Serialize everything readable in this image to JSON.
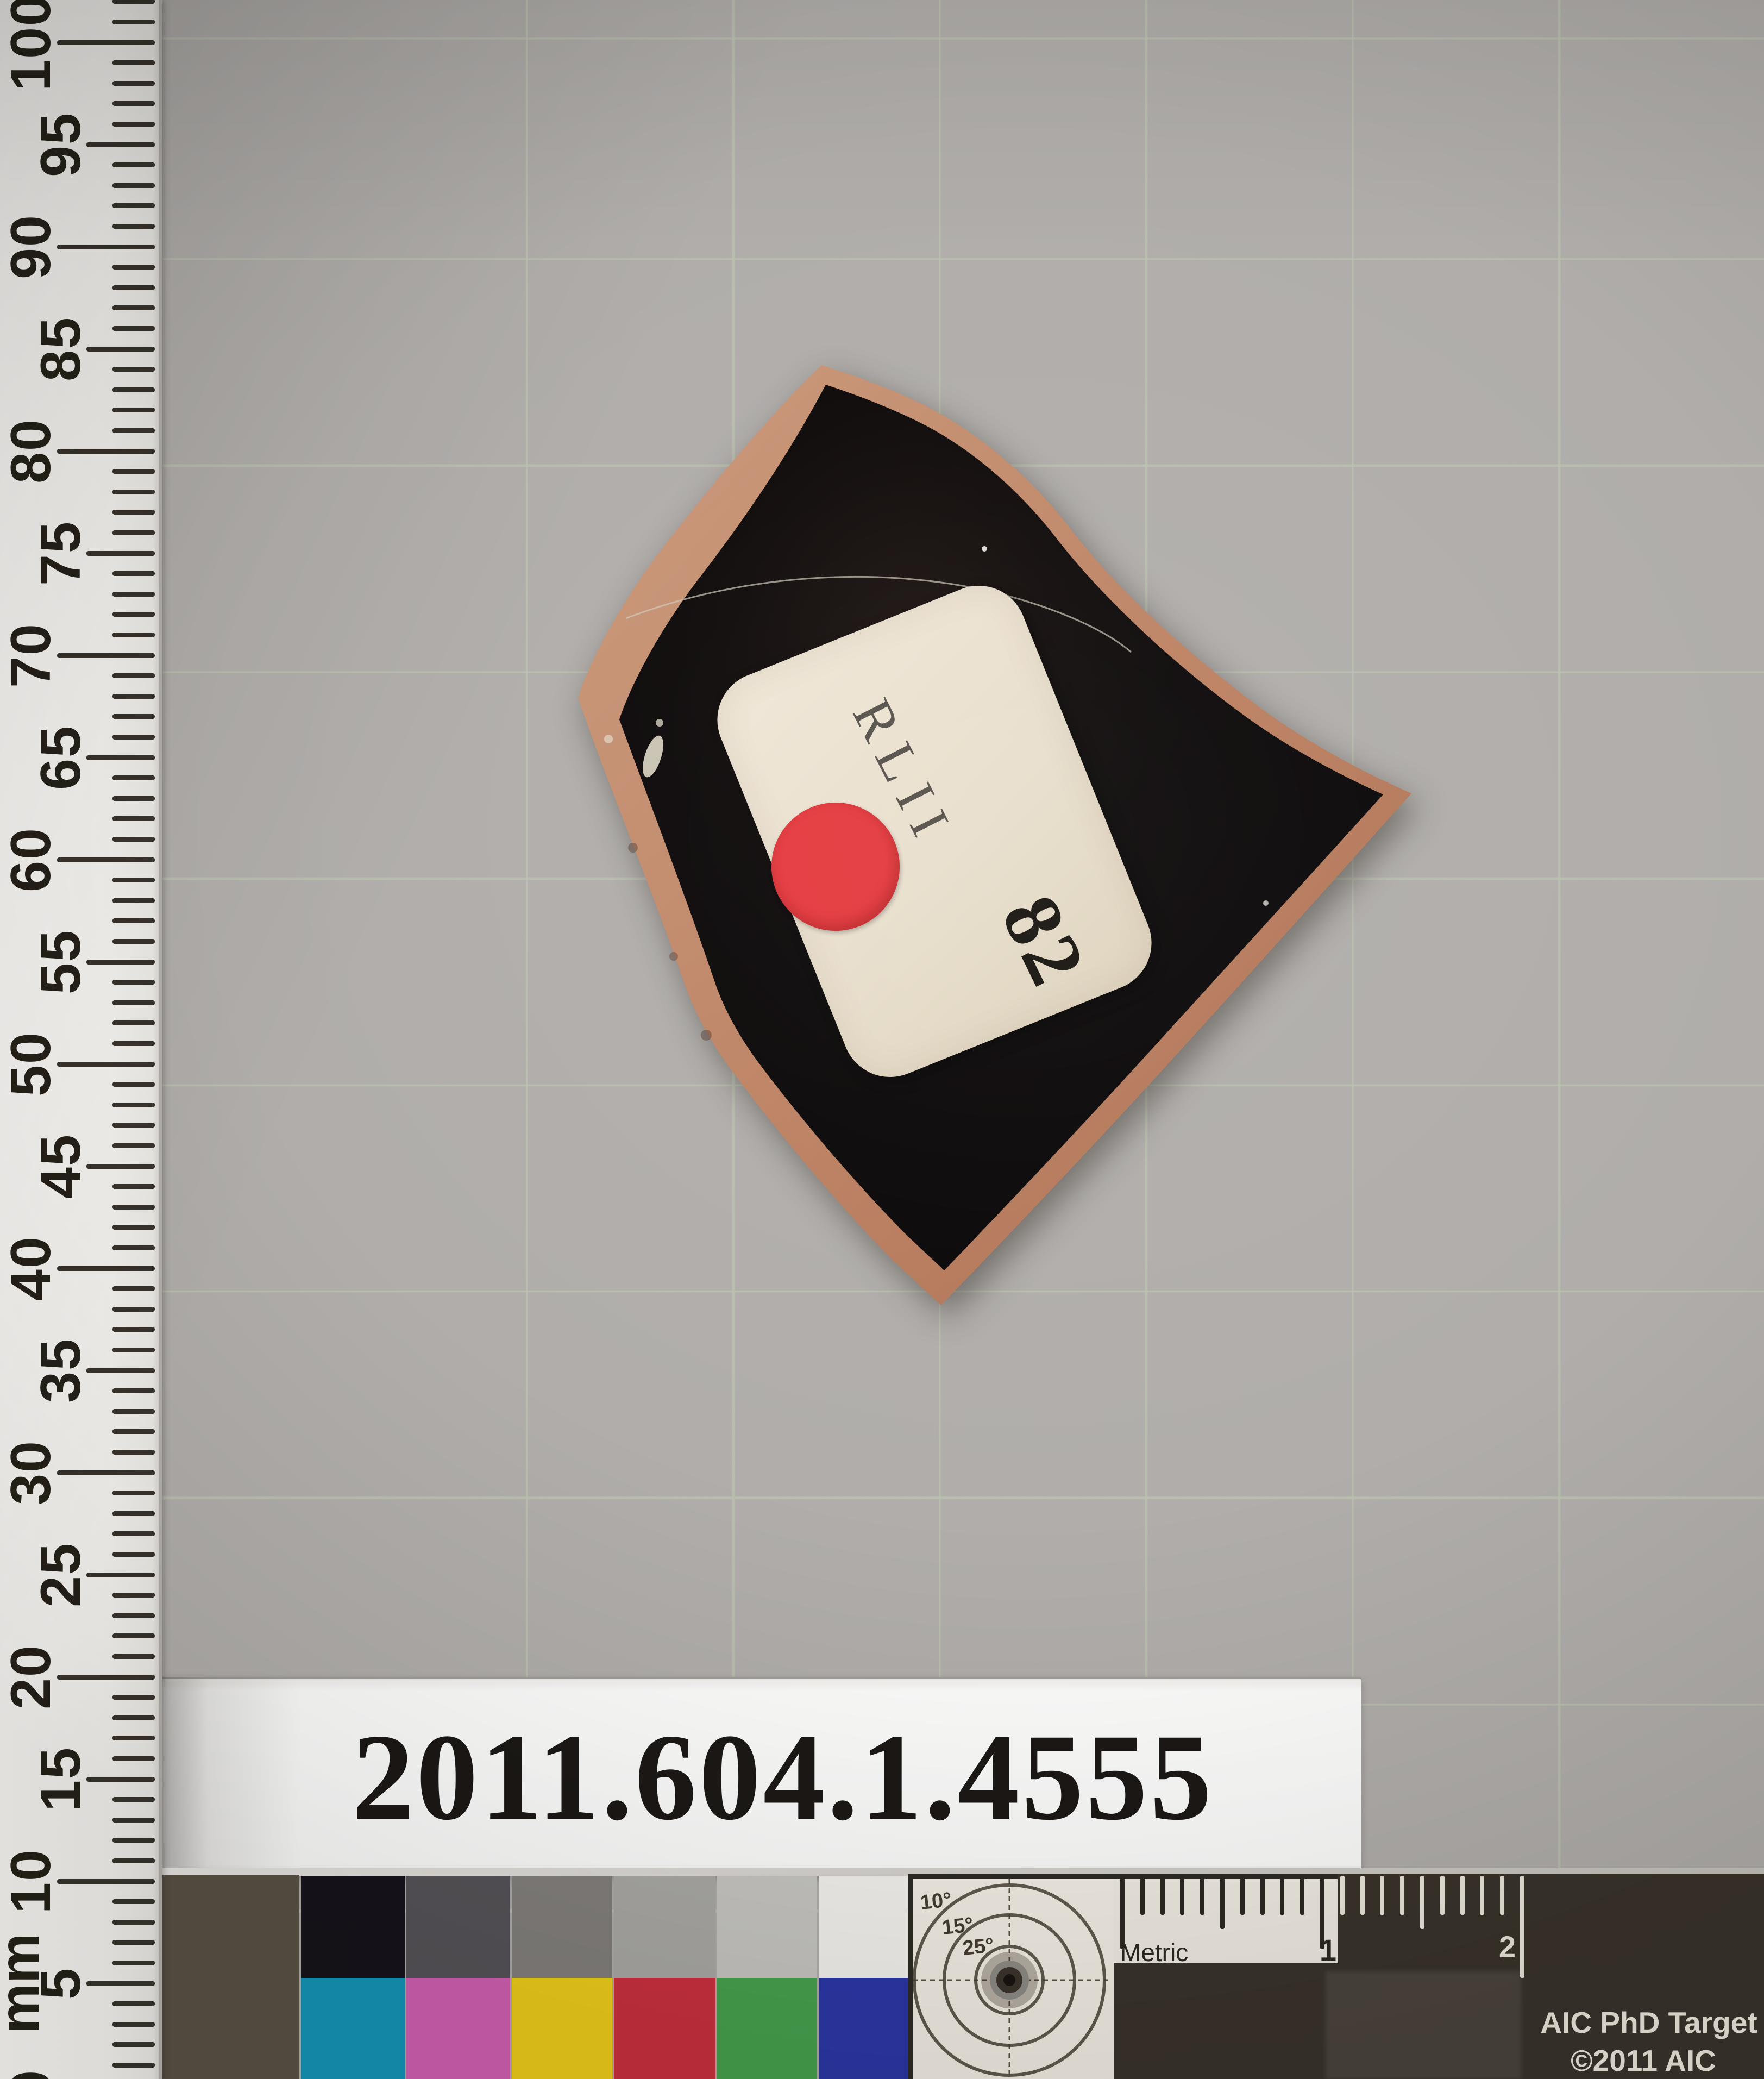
{
  "background": {
    "base": "#b0adaa",
    "grid_line": "#bac1af"
  },
  "ruler": {
    "unit": "mm",
    "values": [
      0,
      5,
      10,
      15,
      20,
      25,
      30,
      35,
      40,
      45,
      50,
      55,
      60,
      65,
      70,
      75,
      80,
      85,
      90,
      95,
      100
    ]
  },
  "sherd": {
    "label_code": "RLII",
    "label_number": "82",
    "red_dot_color": "#e4393e",
    "edge_color_light": "#cb9a7c",
    "edge_color_dark": "#ad6f52",
    "body_color": "#0a0708",
    "label_paper_color": "#e8decc"
  },
  "accession_label": {
    "number": "2011.604.1.4555"
  },
  "calibration_target": {
    "brand_line1": "AIC PhD Target",
    "brand_line2": "©2011 AIC",
    "metric_label": "Metric",
    "cm_labels": [
      "1",
      "2"
    ],
    "degree_labels": [
      "10°",
      "15°",
      "25°"
    ],
    "fabric_patch_color": "#595144",
    "board_color": "#39332b",
    "gray_patches": [
      "#16131a",
      "#565358",
      "#827f7c",
      "#a9a8a4",
      "#c6c5c1",
      "#f3f1ed"
    ],
    "color_patches": [
      "#1695b8",
      "#d160b2",
      "#eecd1b",
      "#c9303e",
      "#46a14e",
      "#2b38a6"
    ]
  }
}
